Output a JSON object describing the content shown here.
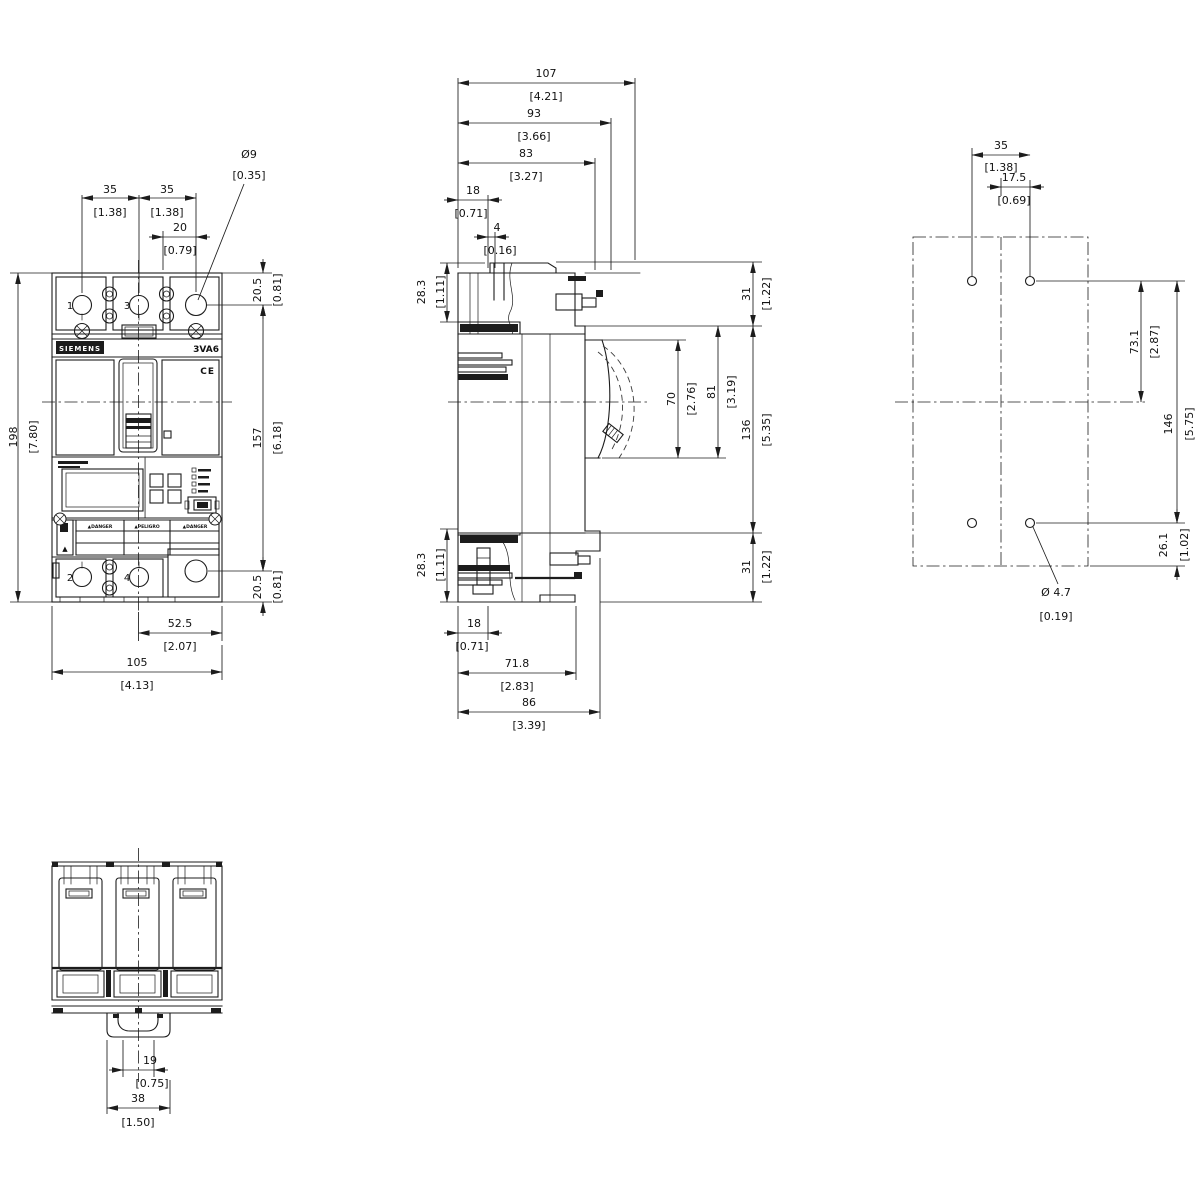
{
  "device": {
    "brand": "SIEMENS",
    "model": "3VA6",
    "ce_mark": "CE",
    "terminal_labels": {
      "t1": "1",
      "t3": "3",
      "t2": "2",
      "t4": "4"
    },
    "warning_labels": {
      "w1": "▲DANGER",
      "w2": "▲PELIGRO",
      "w3": "▲DANGER"
    },
    "warning_flag": "▲"
  },
  "dims": {
    "front": {
      "pitch_left": {
        "mm": "35",
        "in": "[1.38]"
      },
      "pitch_right": {
        "mm": "35",
        "in": "[1.38]"
      },
      "hole_offset": {
        "mm": "20",
        "in": "[0.79]"
      },
      "hole_dia": {
        "mm": "Ø9",
        "in": "[0.35]"
      },
      "top_margin": {
        "mm": "20.5",
        "in": "[0.81]"
      },
      "hole_span": {
        "mm": "157",
        "in": "[6.18]"
      },
      "bottom_margin": {
        "mm": "20.5",
        "in": "[0.81]"
      },
      "height": {
        "mm": "198",
        "in": "[7.80]"
      },
      "center_to_edge": {
        "mm": "52.5",
        "in": "[2.07]"
      },
      "width": {
        "mm": "105",
        "in": "[4.13]"
      }
    },
    "side": {
      "depth_max": {
        "mm": "107",
        "in": "[4.21]"
      },
      "depth_escutcheon": {
        "mm": "93",
        "in": "[3.66]"
      },
      "depth_cover": {
        "mm": "83",
        "in": "[3.27]"
      },
      "terminal_depth": {
        "mm": "18",
        "in": "[0.71]"
      },
      "screw_offset": {
        "mm": "4",
        "in": "[0.16]"
      },
      "top_terminal_h": {
        "mm": "28.3",
        "in": "[1.11]"
      },
      "bottom_terminal_h": {
        "mm": "28.3",
        "in": "[1.11]"
      },
      "top_front_h": {
        "mm": "31",
        "in": "[1.22]"
      },
      "handle_opening": {
        "mm": "70",
        "in": "[2.76]"
      },
      "escutcheon_h": {
        "mm": "81",
        "in": "[3.19]"
      },
      "body_h": {
        "mm": "136",
        "in": "[5.35]"
      },
      "bottom_front_h": {
        "mm": "31",
        "in": "[1.22]"
      },
      "terminal_depth_b": {
        "mm": "18",
        "in": "[0.71]"
      },
      "base_depth": {
        "mm": "71.8",
        "in": "[2.83]"
      },
      "mount_depth": {
        "mm": "86",
        "in": "[3.39]"
      }
    },
    "drill": {
      "hole_pitch": {
        "mm": "35",
        "in": "[1.38]"
      },
      "center_offset": {
        "mm": "17.5",
        "in": "[0.69]"
      },
      "row_to_center": {
        "mm": "73.1",
        "in": "[2.87]"
      },
      "row_span": {
        "mm": "146",
        "in": "[5.75]"
      },
      "bottom_offset": {
        "mm": "26.1",
        "in": "[1.02]"
      },
      "hole_dia": {
        "mm": "Ø 4.7",
        "in": "[0.19]"
      }
    },
    "bottom": {
      "rail_clip": {
        "mm": "19",
        "in": "[0.75]"
      },
      "rail_width": {
        "mm": "38",
        "in": "[1.50]"
      }
    }
  }
}
